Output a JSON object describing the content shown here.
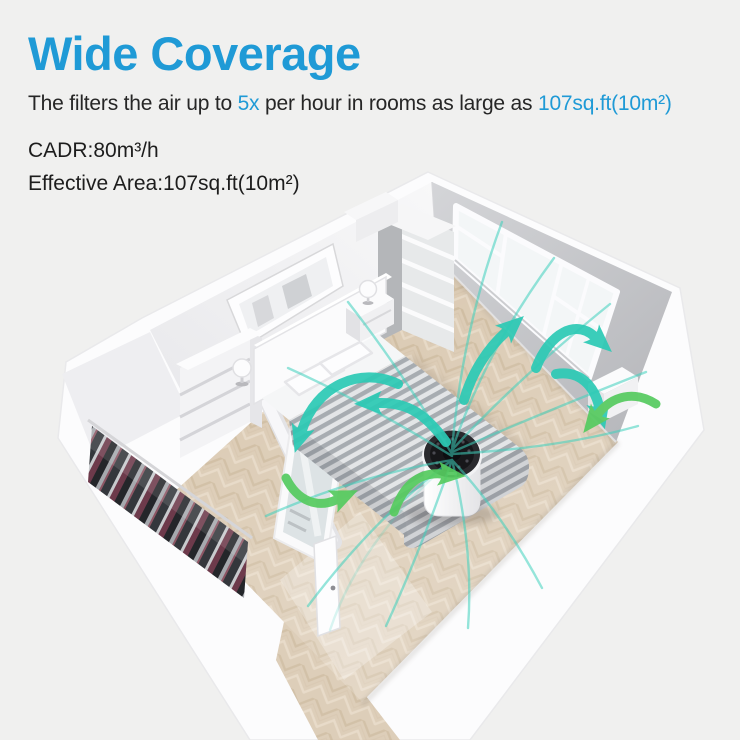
{
  "page": {
    "background": "#f0f0ef"
  },
  "header": {
    "title": "Wide Coverage",
    "title_color": "#1f9ad6",
    "subtitle_part1": "The filters the air up to ",
    "subtitle_highlight1": "5x",
    "subtitle_part2": " per hour in rooms as large as ",
    "subtitle_highlight2": "107sq.ft(10m²)",
    "spec_cadr": "CADR:80m³/h",
    "spec_area": "Effective Area:107sq.ft(10m²)"
  },
  "illustration": {
    "alt": "Isometric bedroom cutaway with air purifier circulating air to every corner",
    "airflow_teal_color": "#2ccab5",
    "airflow_green_color": "#55cb5f",
    "airflow_line_color": "#3fd1bd",
    "floor_color": "#d8c6ad",
    "wall_gray_color": "#c6c7ca"
  }
}
